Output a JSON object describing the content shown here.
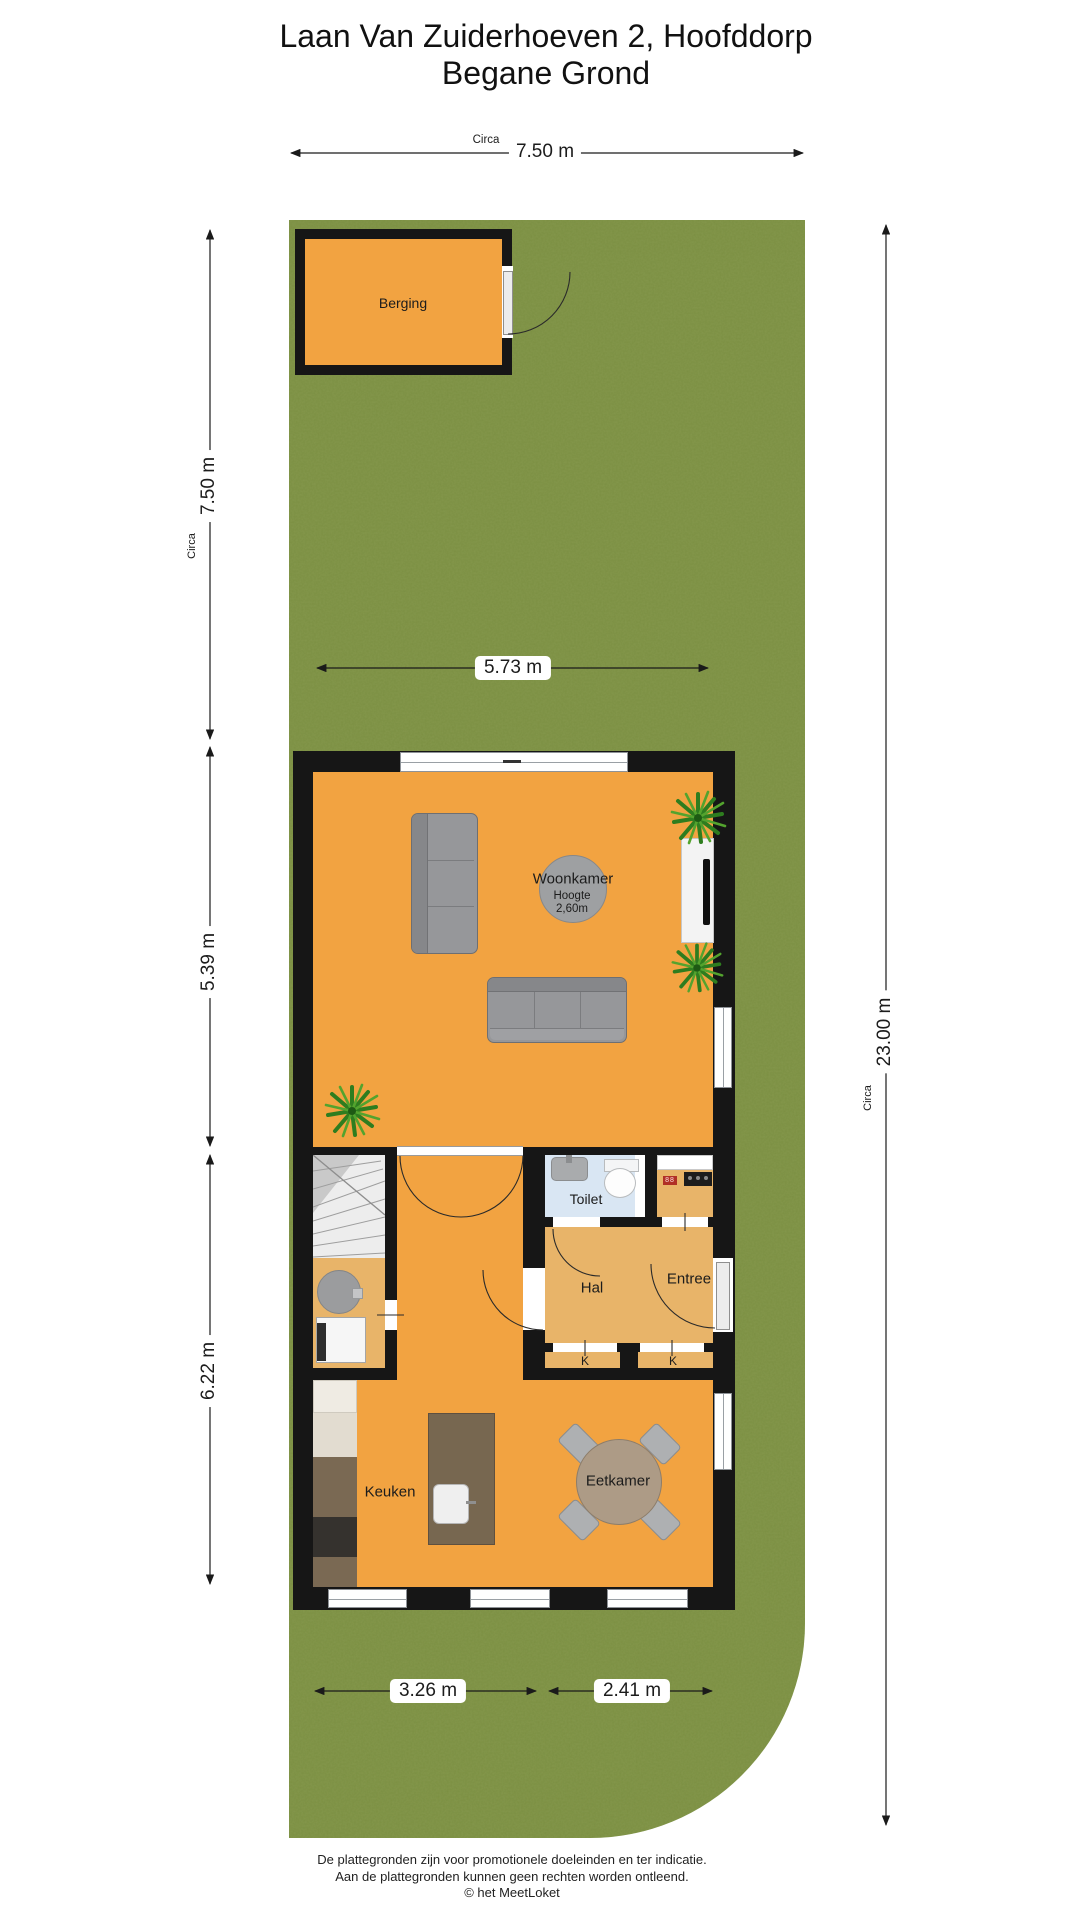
{
  "title": {
    "line1": "Laan Van Zuiderhoeven 2, Hoofddorp",
    "line2": "Begane Grond"
  },
  "dimensions": {
    "top_width": {
      "circa": "Circa",
      "value": "7.50 m"
    },
    "garden_depth": {
      "circa": "Circa",
      "value": "7.50 m"
    },
    "garden_width": {
      "value": "5.73 m"
    },
    "living_depth": {
      "value": "5.39 m"
    },
    "kitchen_depth": {
      "value": "6.22 m"
    },
    "plot_depth": {
      "circa": "Circa",
      "value": "23.00 m"
    },
    "kitchen_width": {
      "value": "3.26 m"
    },
    "dining_width": {
      "value": "2.41 m"
    }
  },
  "rooms": {
    "berging": "Berging",
    "woonkamer": "Woonkamer",
    "woonkamer_hoogte_label": "Hoogte",
    "woonkamer_hoogte_value": "2,60m",
    "toilet": "Toilet",
    "hal": "Hal",
    "entree": "Entree",
    "kast_left": "K",
    "kast_right": "K",
    "keuken": "Keuken",
    "eetkamer": "Eetkamer"
  },
  "footer": {
    "line1": "De plattegronden zijn voor promotionele doeleinden en ter indicatie.",
    "line2": "Aan de plattegronden kunnen geen rechten worden ontleend.",
    "copyright": "© het MeetLoket"
  },
  "colors": {
    "grass": "#7B8F42",
    "floor": "#F2A341",
    "floor_light": "#E8B469",
    "toilet_floor": "#D9E6F3",
    "wall": "#161616",
    "wood": "#AD9B86",
    "island": "#776750"
  }
}
